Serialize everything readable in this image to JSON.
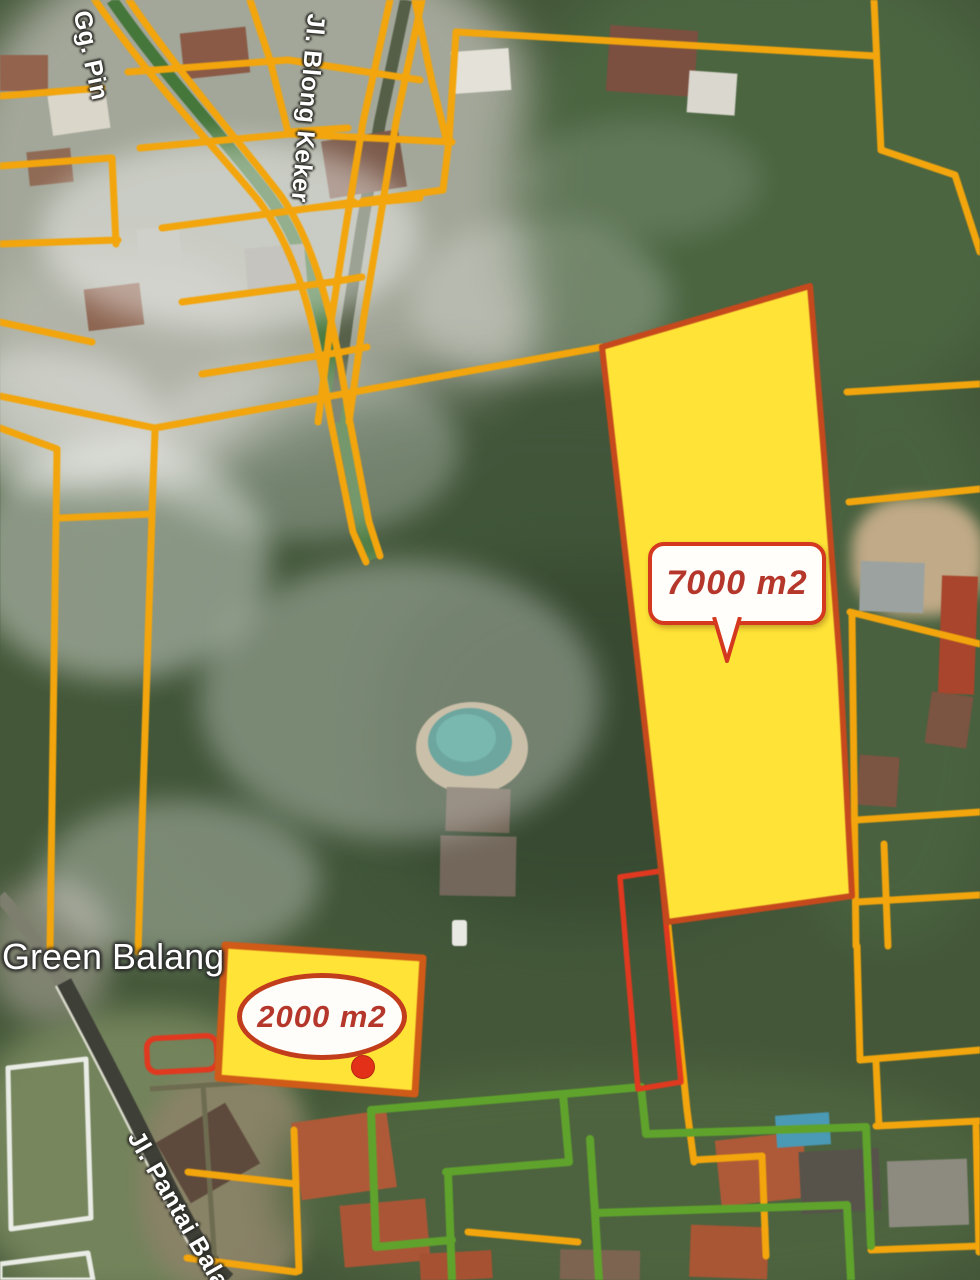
{
  "map": {
    "view": "satellite",
    "road_labels": [
      {
        "id": "gg-pin",
        "text": "Gg. Pin"
      },
      {
        "id": "jl-blong-keker",
        "text": "Jl. Blong Keker"
      },
      {
        "id": "jl-pantai-balangan",
        "text": "Jl. Pantai Balan"
      }
    ],
    "place_label": {
      "text": "Green Balang"
    },
    "plots": [
      {
        "id": "plot-7000",
        "label": "7000 m2",
        "area_m2": 7000,
        "fill": "#FFE437",
        "outline": "#C5491D",
        "callout": "speech-bubble"
      },
      {
        "id": "plot-2000",
        "label": "2000 m2",
        "area_m2": 2000,
        "fill": "#FFE437",
        "outline": "#D05A17",
        "callout": "ellipse-pointer"
      }
    ],
    "overlay_colors": {
      "parcel_line_orange": "#F2A50C",
      "parcel_line_green": "#5FA32C",
      "highlight_red": "#E03920",
      "callout_text": "#B5372B"
    }
  }
}
